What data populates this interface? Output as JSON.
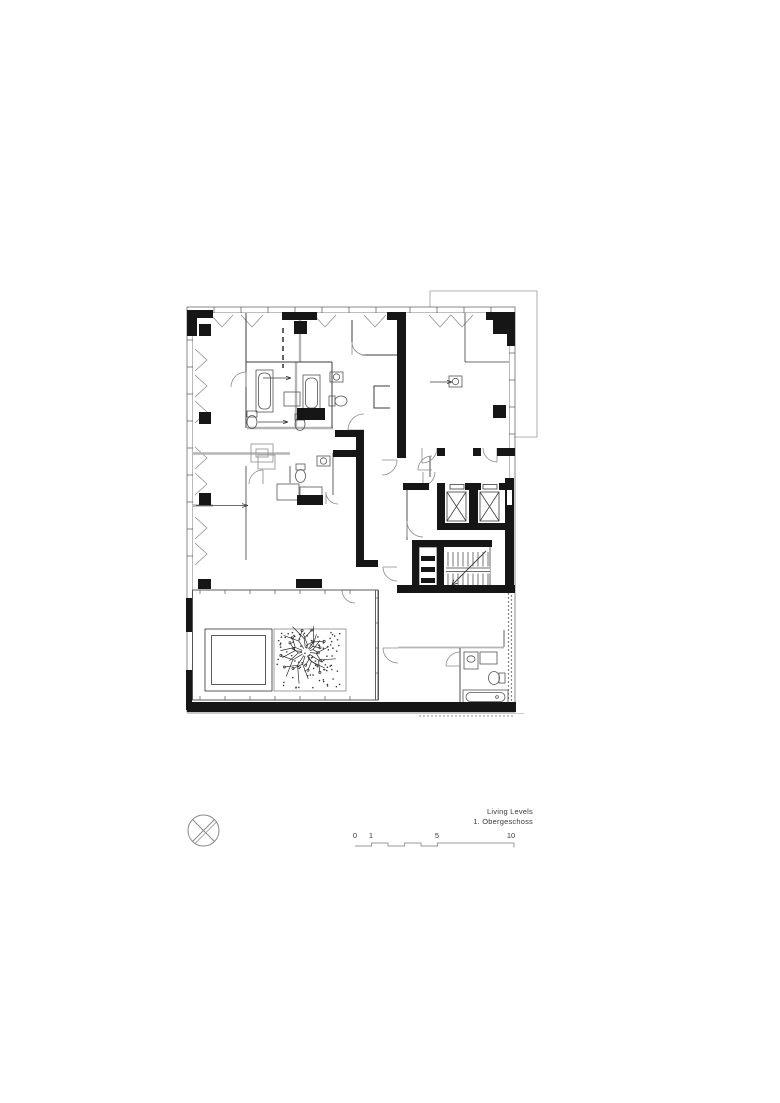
{
  "drawing": {
    "title_line1": "Living Levels",
    "title_line2": "1. Obergeschoss"
  },
  "scale_bar": {
    "labels": [
      "0",
      "1",
      "5",
      "10"
    ]
  },
  "icons": {
    "north_arrow": "compass-circle-x-north-arrow"
  },
  "colors": {
    "wall_black": "#161616",
    "line_dark": "#3c3c3c",
    "line_gray": "#b5b5b5",
    "facade_gray": "#9a9a9a",
    "background": "#ffffff"
  }
}
